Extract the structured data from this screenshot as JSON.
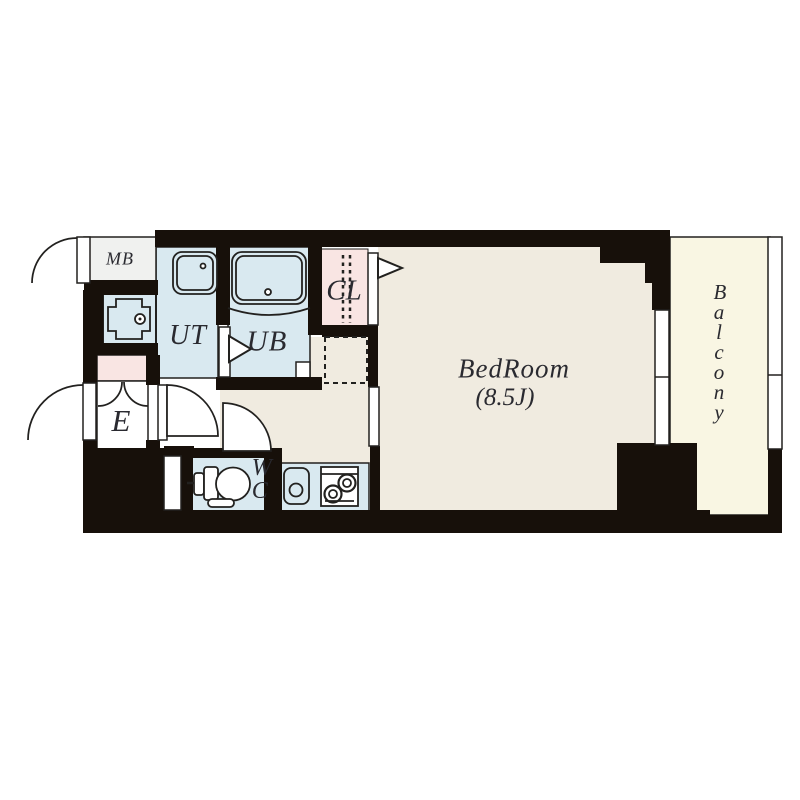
{
  "plan": {
    "rooms": {
      "meter_box": {
        "label": "MB"
      },
      "utility": {
        "label": "UT"
      },
      "unit_bath": {
        "label": "UB"
      },
      "closet": {
        "label": "CL"
      },
      "entrance": {
        "label": "E"
      },
      "toilet": {
        "label": "WC"
      },
      "bedroom": {
        "label": "BedRoom",
        "size": "(8.5J)"
      },
      "balcony": {
        "label": "Balcony"
      }
    }
  },
  "colors": {
    "wall": "#17100a",
    "floor-beige": "#f0ebe0",
    "floor-cream": "#f9f6e3",
    "floor-blue": "#d9e9f0",
    "floor-pink": "#f9e5e3",
    "floor-gray": "#f0f1ef",
    "floor-white": "#ffffff",
    "line": "#22211f",
    "ink": "#2a2a30"
  }
}
